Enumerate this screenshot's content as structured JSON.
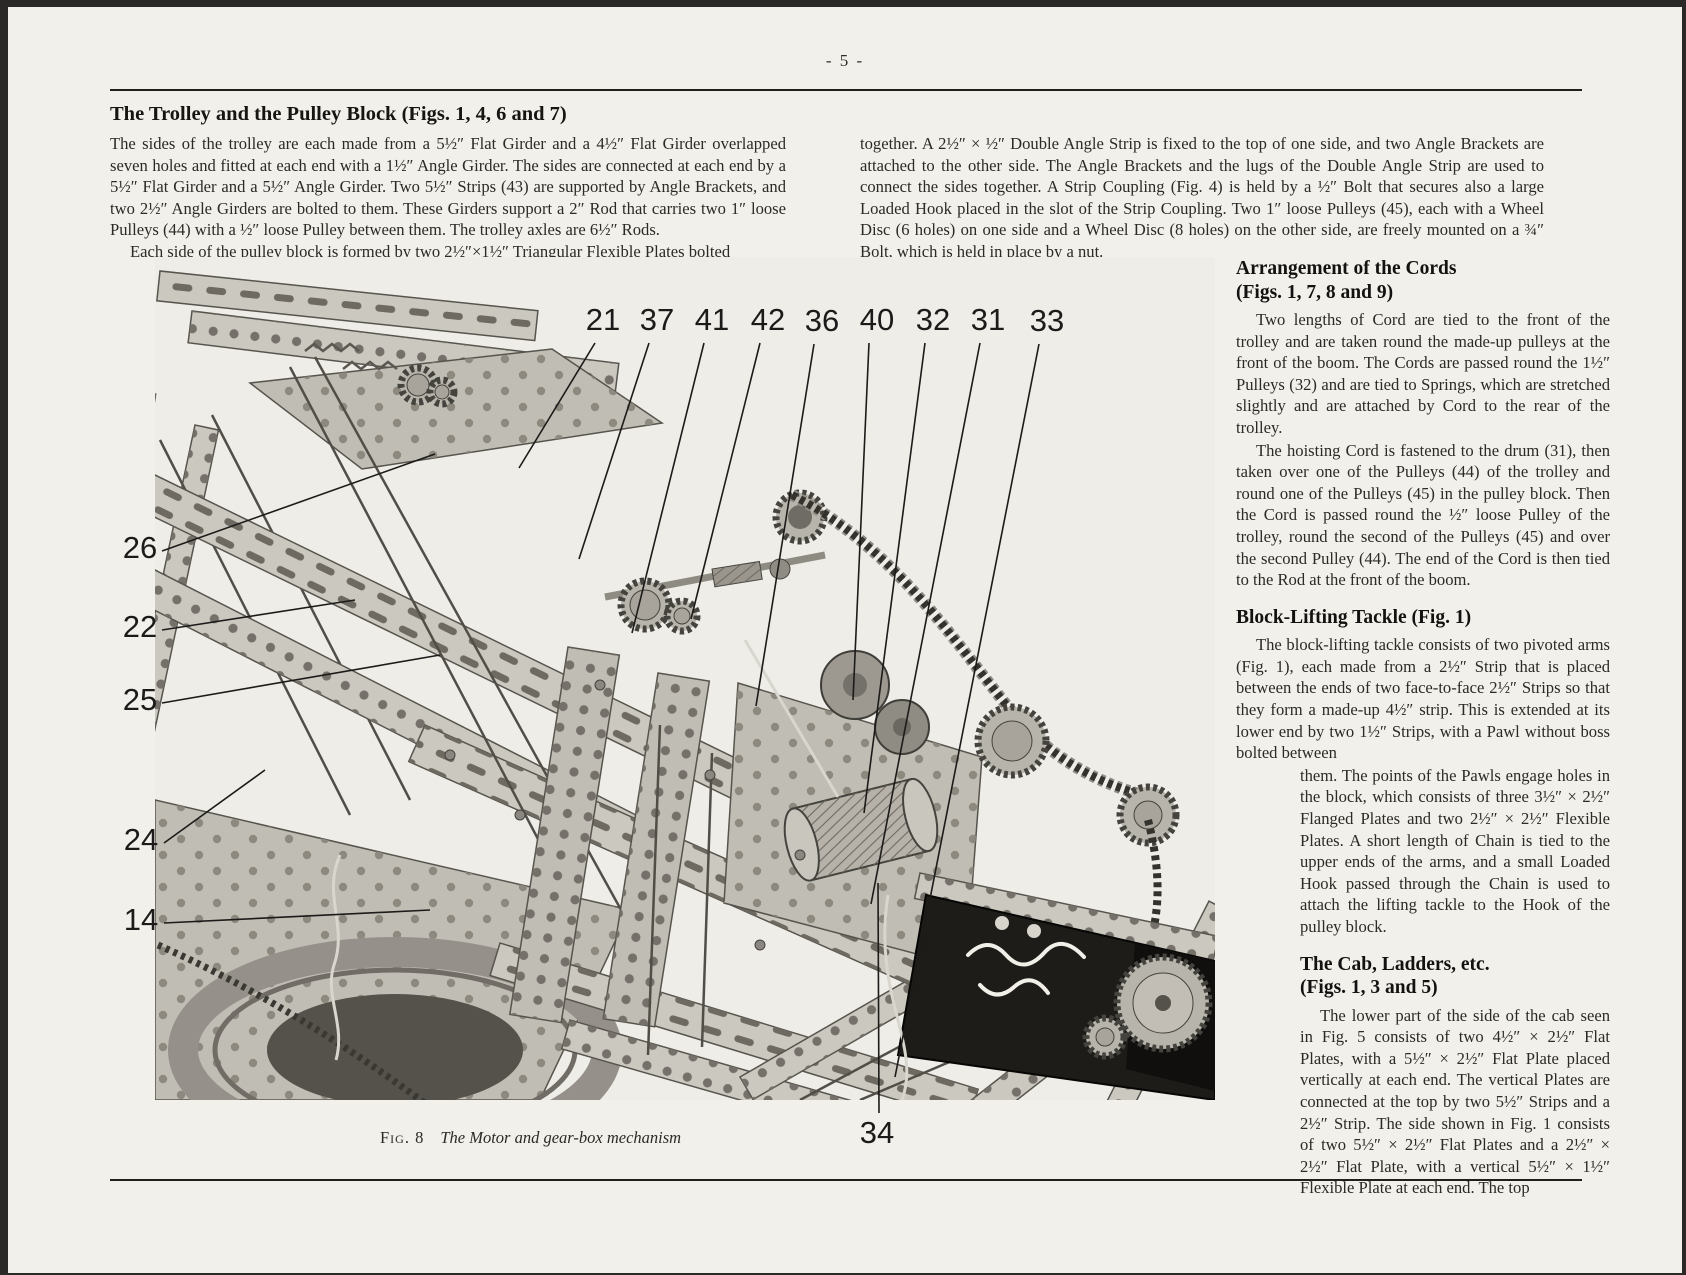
{
  "page": {
    "number": "- 5 -"
  },
  "intro": {
    "heading": "The Trolley and the Pulley Block (Figs. 1, 4, 6 and 7)",
    "left_p1": "The sides of the trolley are each made from a 5½″ Flat Girder and a 4½″ Flat Girder overlapped seven holes and fitted at each end with a 1½″ Angle Girder. The sides are connected at each end by a 5½″ Flat Girder and a 5½″ Angle Girder. Two 5½″ Strips (43) are supported by Angle Brackets, and two 2½″ Angle Girders are bolted to them. These Girders support a 2″ Rod that carries two 1″ loose Pulleys (44) with a ½″ loose Pulley between them. The trolley axles are 6½″ Rods.",
    "left_p2": "Each side of the pulley block is formed by two 2½″×1½″ Triangular Flexible Plates bolted",
    "right_p1": "together. A 2½″ × ½″ Double Angle Strip is fixed to the top of one side, and two Angle Brackets are attached to the other side. The Angle Brackets and the lugs of the Double Angle Strip are used to connect the sides together. A Strip Coupling (Fig. 4) is held by a ½″ Bolt that secures also a large Loaded Hook placed in the slot of the Strip Coupling. Two 1″ loose Pulleys (45), each with a Wheel Disc (6 holes) on one side and a Wheel Disc (8 holes) on the other side, are freely mounted on a ¾″ Bolt, which is held in place by a nut."
  },
  "figure": {
    "caption_label": "Fig. 8",
    "caption_text": "The Motor and gear-box mechanism",
    "callouts": [
      {
        "label": "21",
        "x": 503,
        "y": 75,
        "x1": 495,
        "y1": 88,
        "x2": 419,
        "y2": 213
      },
      {
        "label": "37",
        "x": 557,
        "y": 75,
        "x1": 549,
        "y1": 88,
        "x2": 479,
        "y2": 304
      },
      {
        "label": "41",
        "x": 612,
        "y": 75,
        "x1": 604,
        "y1": 88,
        "x2": 532,
        "y2": 378
      },
      {
        "label": "42",
        "x": 668,
        "y": 75,
        "x1": 660,
        "y1": 88,
        "x2": 591,
        "y2": 364
      },
      {
        "label": "36",
        "x": 722,
        "y": 76,
        "x1": 714,
        "y1": 89,
        "x2": 656,
        "y2": 451
      },
      {
        "label": "40",
        "x": 777,
        "y": 75,
        "x1": 769,
        "y1": 88,
        "x2": 753,
        "y2": 445
      },
      {
        "label": "32",
        "x": 833,
        "y": 75,
        "x1": 825,
        "y1": 88,
        "x2": 764,
        "y2": 558
      },
      {
        "label": "31",
        "x": 888,
        "y": 75,
        "x1": 880,
        "y1": 88,
        "x2": 771,
        "y2": 649
      },
      {
        "label": "33",
        "x": 947,
        "y": 76,
        "x1": 939,
        "y1": 89,
        "x2": 795,
        "y2": 822
      },
      {
        "label": "26",
        "x": 40,
        "y": 303,
        "x1": 62,
        "y1": 296,
        "x2": 335,
        "y2": 199
      },
      {
        "label": "22",
        "x": 40,
        "y": 382,
        "x1": 62,
        "y1": 375,
        "x2": 255,
        "y2": 345
      },
      {
        "label": "25",
        "x": 40,
        "y": 455,
        "x1": 62,
        "y1": 448,
        "x2": 340,
        "y2": 400
      },
      {
        "label": "24",
        "x": 41,
        "y": 595,
        "x1": 64,
        "y1": 588,
        "x2": 165,
        "y2": 515
      },
      {
        "label": "14",
        "x": 41,
        "y": 675,
        "x1": 64,
        "y1": 668,
        "x2": 330,
        "y2": 655
      },
      {
        "label": "34",
        "x": 777,
        "y": 888,
        "x1": 779,
        "y1": 858,
        "x2": 778,
        "y2": 628
      }
    ]
  },
  "sidebar": {
    "s1_title1": "Arrangement of the Cords",
    "s1_title2": "(Figs. 1, 7, 8 and 9)",
    "s1_p1": "Two lengths of Cord are tied to the front of the trolley and are taken round the made-up pulleys at the front of the boom. The Cords are passed round the 1½″ Pulleys (32) and are tied to Springs, which are stretched slightly and are attached by Cord to the rear of the trolley.",
    "s1_p2": "The hoisting Cord is fastened to the drum (31), then taken over one of the Pulleys (44) of the trolley and round one of the Pulleys (45) in the pulley block. Then the Cord is passed round the ½″ loose Pulley of the trolley, round the second of the Pulleys (45) and over the second Pulley (44). The end of the Cord is then tied to the Rod at the front of the boom.",
    "s2_title": "Block-Lifting Tackle (Fig. 1)",
    "s2_p1a": "The block-lifting tackle consists of two pivoted arms (Fig. 1), each made from a 2½″ Strip that is placed between the ends of two face-to-face 2½″ Strips so that they form a made-up 4½″ strip. This is extended at its lower end by two 1½″ Strips, with a Pawl without boss bolted between",
    "s2_p1b": "them. The points of the Pawls engage holes in the block, which consists of three 3½″ × 2½″ Flanged Plates and two 2½″ × 2½″ Flexible Plates. A short length of Chain is tied to the upper ends of the arms, and a small Loaded Hook passed through the Chain is used to attach the lifting tackle to the Hook of the pulley block.",
    "s3_title1": "The Cab, Ladders, etc.",
    "s3_title2": "(Figs. 1, 3 and 5)",
    "s3_p1": "The lower part of the side of the cab seen in Fig. 5 consists of two 4½″ × 2½″ Flat Plates, with a 5½″ × 2½″ Flat Plate placed vertically at each end. The vertical Plates are connected at the top by two 5½″ Strips and a 2½″ Strip. The side shown in Fig. 1 consists of two 5½″ × 2½″ Flat Plates and a 2½″ × 2½″ Flat Plate, with a vertical 5½″ × 1½″ Flexible Plate at each end. The top"
  }
}
